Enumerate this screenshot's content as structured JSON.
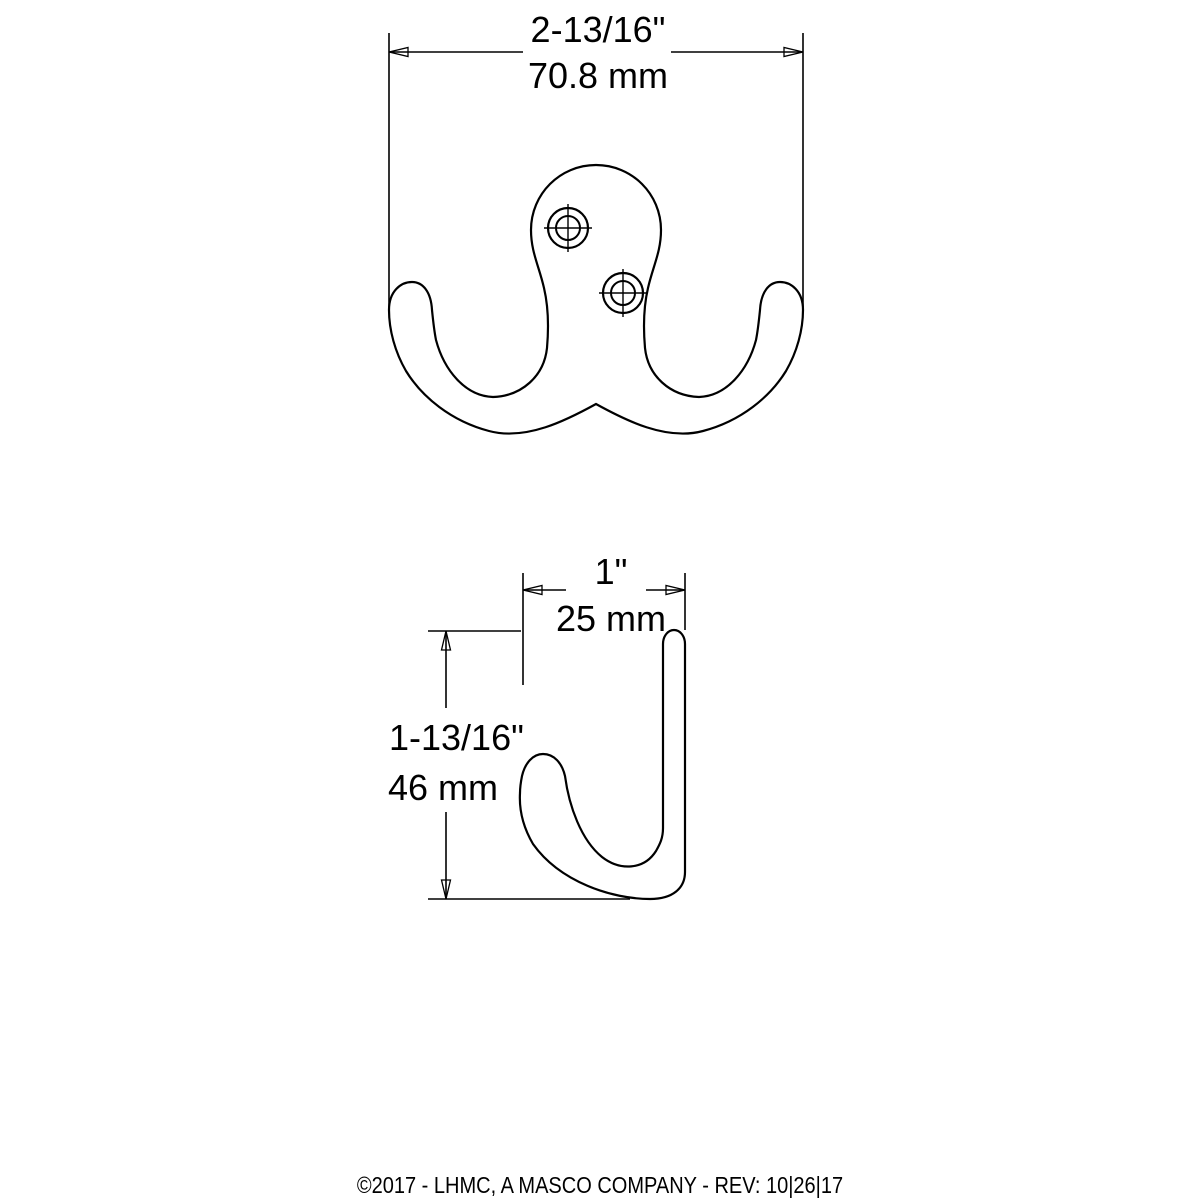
{
  "page": {
    "background": "#ffffff",
    "line_color": "#000000"
  },
  "front_view": {
    "description": "double prong robe hook, front view with two screw holes",
    "screw_hole_count": "2",
    "width_dimension": {
      "inches": "2-13/16\"",
      "mm": "70.8 mm"
    }
  },
  "side_view": {
    "description": "single hook profile, side view",
    "depth_dimension": {
      "inches": "1\"",
      "mm": "25 mm"
    },
    "height_dimension": {
      "inches": "1-13/16\"",
      "mm": "46 mm"
    }
  },
  "footer": {
    "text": "©2017 - LHMC, A MASCO COMPANY - REV: 10|26|17"
  }
}
